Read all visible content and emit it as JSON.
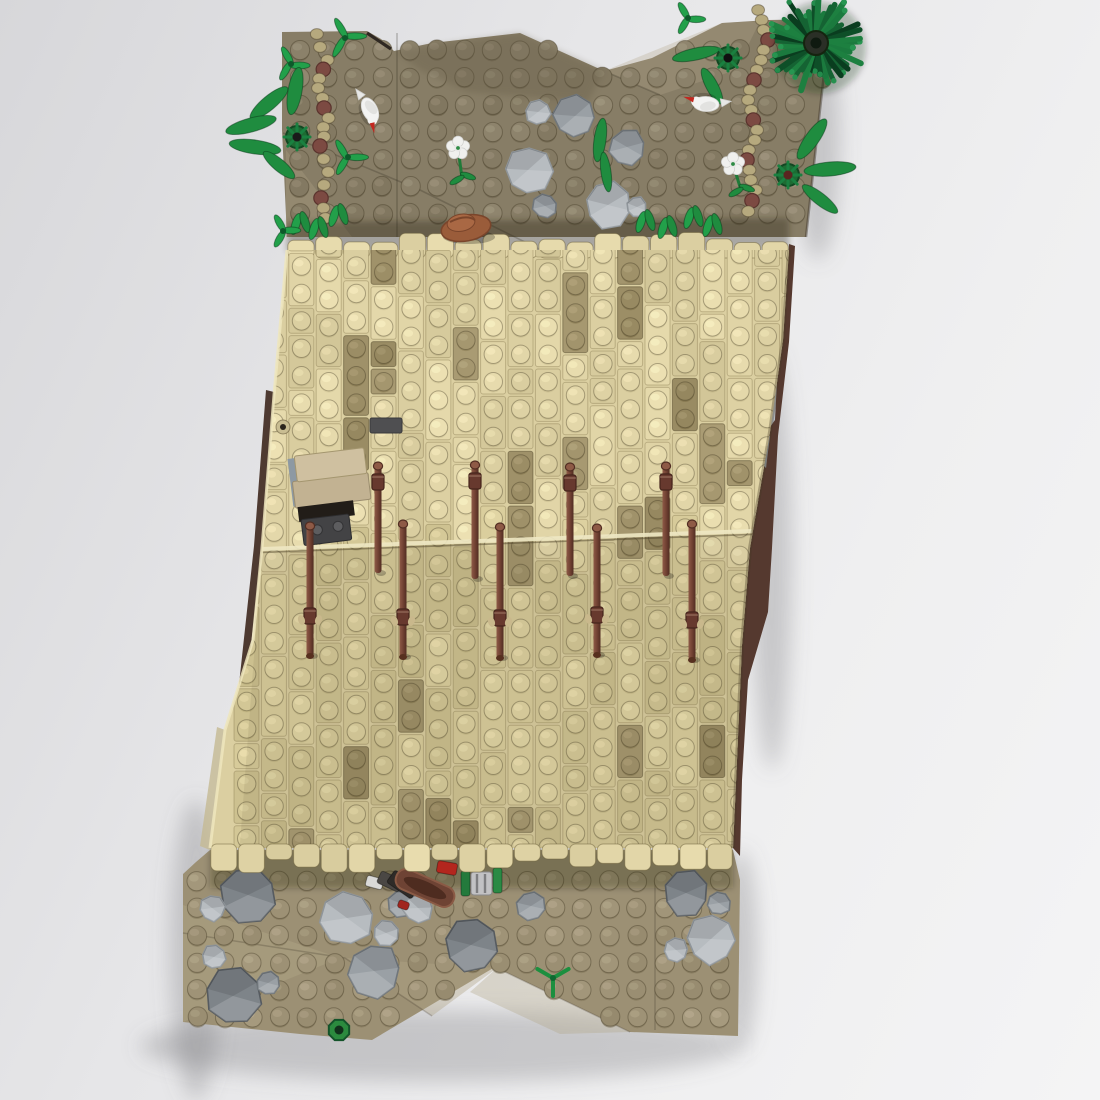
{
  "render": {
    "seed": 11,
    "canvas": {
      "w": 1100,
      "h": 1100
    }
  },
  "palette": {
    "bg_from": "#d7d7da",
    "bg_to": "#f4f4f5",
    "upper_ground": "#877d66",
    "upper_light": "#a59a7d",
    "upper_dark": "#6f6550",
    "lower_ground": "#9c9074",
    "lower_light": "#b2a687",
    "tan_upper": "#dbcfa1",
    "tan_lower": "#d2c695",
    "tan_recess": "#a2946c",
    "tan_deep": "#8a7e5c",
    "tan_light": "#e8dfb6",
    "seam_hi": "#efe8c4",
    "side_dark_left": "#4e3a31",
    "side_dark_right": "#55392f",
    "gray_sliver": "#b2b8bf",
    "gray_sliver2": "#98a2aa",
    "gray_sliver3": "#8d97a1",
    "bar_hi": "#8e5a46",
    "bar_mid": "#6f4032",
    "bar_dark": "#512d22",
    "bar_collar": "#67392e",
    "bar_nub": "#c9b88c",
    "rock_light": "#b7bcc0",
    "rock_mid": "#9aa0a5",
    "rock_dark": "#7e8489",
    "rock_light_s": "#8f959a",
    "rock_mid_s": "#70767b",
    "rock_dark_s": "#565b60",
    "green_bright": "#22a04a",
    "green_mid": "#1f8c3f",
    "green_dark": "#156333",
    "green_deep": "#0e4f28",
    "bird_body": "#f3f3f2",
    "bird_wing": "#e2e2e0",
    "beak_red": "#c3271f",
    "flower_petal": "#f0f0ee",
    "flower_center": "#2e8b44",
    "hat_main": "#9a5c3a",
    "hat_dark": "#7a452b",
    "hat_crown": "#a96844",
    "path_link": "#b6a97e",
    "path_bead": "#7c4a42",
    "shadow": "rgba(108,108,116,0.30)"
  },
  "upper_ground": {
    "outline": [
      [
        282,
        32
      ],
      [
        367,
        31
      ],
      [
        381,
        39
      ],
      [
        394,
        51
      ],
      [
        432,
        43
      ],
      [
        520,
        33
      ],
      [
        604,
        71
      ],
      [
        652,
        58
      ],
      [
        722,
        23
      ],
      [
        768,
        20
      ],
      [
        830,
        19
      ],
      [
        806,
        237
      ],
      [
        287,
        237
      ],
      [
        282,
        130
      ]
    ],
    "light_faces": [
      {
        "pts": [
          [
            604,
            71
          ],
          [
            722,
            23
          ],
          [
            760,
            21
          ],
          [
            736,
            70
          ],
          [
            660,
            95
          ]
        ],
        "fill": "#b3a78a",
        "op": 0.3
      },
      {
        "pts": [
          [
            286,
            150
          ],
          [
            352,
            237
          ],
          [
            286,
            237
          ]
        ],
        "fill": "#a59a7d",
        "op": 0.45
      }
    ],
    "dark_faces": [
      {
        "pts": [
          [
            394,
            51
          ],
          [
            520,
            33
          ],
          [
            604,
            71
          ],
          [
            588,
            102
          ],
          [
            468,
            92
          ],
          [
            420,
            70
          ]
        ],
        "fill": "#5e5440",
        "op": 0.28
      },
      {
        "pts": [
          [
            287,
            222
          ],
          [
            789,
            218
          ],
          [
            789,
            250
          ],
          [
            287,
            252
          ]
        ],
        "fill": "#241d10",
        "op": 0.32
      }
    ],
    "crease_lines": [
      [
        [
          420,
          190
        ],
        [
          545,
          252
        ]
      ],
      [
        [
          283,
          133
        ],
        [
          420,
          190
        ]
      ],
      [
        [
          604,
          71
        ],
        [
          660,
          95
        ]
      ],
      [
        [
          397,
          33
        ],
        [
          397,
          237
        ]
      ]
    ],
    "notch": [
      [
        367,
        33
      ],
      [
        391,
        49
      ]
    ],
    "stud_grid": {
      "x0": 300,
      "y0": 50,
      "dx": 27.5,
      "dy": 27.3,
      "cols": 20,
      "rows": 7,
      "r": 9.6
    }
  },
  "waterfall": {
    "body": [
      [
        287,
        250
      ],
      [
        789,
        250
      ],
      [
        783,
        340
      ],
      [
        770,
        432
      ],
      [
        750,
        548
      ],
      [
        742,
        645
      ],
      [
        737,
        760
      ],
      [
        733,
        848
      ],
      [
        210,
        848
      ],
      [
        225,
        730
      ],
      [
        253,
        640
      ],
      [
        262,
        548
      ],
      [
        274,
        395
      ]
    ],
    "top_teeth": {
      "x1": 287,
      "x2": 789,
      "base": 254,
      "hmin": 10,
      "hmax": 22,
      "w": 27.9
    },
    "bottom_teeth": {
      "x1": 210,
      "x2": 733,
      "base": 846,
      "hmin": 10,
      "hmax": 26,
      "w": 27.6
    },
    "left_edge": [
      [
        210,
        848
      ],
      [
        225,
        730
      ],
      [
        253,
        640
      ],
      [
        262,
        548
      ],
      [
        274,
        395
      ],
      [
        287,
        250
      ]
    ],
    "right_edge": [
      [
        789,
        250
      ],
      [
        783,
        340
      ],
      [
        770,
        432
      ],
      [
        750,
        548
      ],
      [
        742,
        645
      ],
      [
        737,
        760
      ],
      [
        733,
        848
      ]
    ],
    "seam": {
      "from": [
        262,
        549
      ],
      "to": [
        752,
        531
      ]
    },
    "columns": {
      "x0": 233,
      "dx": 27.4,
      "count": 21,
      "ytop": 231,
      "ybot": 860
    },
    "technic_hole": [
      283,
      427
    ],
    "dark_tile": {
      "x": 370,
      "y": 418,
      "w": 32,
      "h": 15
    }
  },
  "lower_ground": {
    "outline": [
      [
        196,
        862
      ],
      [
        210,
        850
      ],
      [
        733,
        850
      ],
      [
        740,
        880
      ],
      [
        738,
        1036
      ],
      [
        630,
        1032
      ],
      [
        495,
        967
      ],
      [
        372,
        1040
      ],
      [
        300,
        1034
      ],
      [
        183,
        1022
      ],
      [
        183,
        874
      ]
    ],
    "light_faces": [
      {
        "pts": [
          [
            183,
            905
          ],
          [
            340,
            958
          ],
          [
            183,
            1022
          ]
        ],
        "fill": "#b2a687",
        "op": 0.45
      },
      {
        "pts": [
          [
            345,
            958
          ],
          [
            497,
            968
          ],
          [
            432,
            1016
          ]
        ],
        "fill": "#b2a687",
        "op": 0.4
      },
      {
        "pts": [
          [
            497,
            968
          ],
          [
            630,
            1032
          ],
          [
            560,
            1034
          ],
          [
            470,
            992
          ]
        ],
        "fill": "#b2a687",
        "op": 0.35
      }
    ],
    "crease_lines": [
      [
        [
          183,
          933
        ],
        [
          345,
          958
        ]
      ],
      [
        [
          345,
          958
        ],
        [
          432,
          1016
        ]
      ],
      [
        [
          497,
          968
        ],
        [
          630,
          1032
        ]
      ],
      [
        [
          450,
          880
        ],
        [
          450,
          962
        ]
      ],
      [
        [
          655,
          880
        ],
        [
          655,
          1030
        ]
      ]
    ],
    "teeth_shadow": [
      [
        210,
        850
      ],
      [
        733,
        850
      ],
      [
        733,
        888
      ],
      [
        210,
        888
      ]
    ],
    "stud_grid": {
      "x0": 197,
      "y0": 881,
      "dx": 27.5,
      "dy": 27.2,
      "cols": 20,
      "rows": 7,
      "r": 9.6
    }
  },
  "side": {
    "left_strip": [
      [
        274,
        392
      ],
      [
        262,
        548
      ],
      [
        238,
        760
      ],
      [
        231,
        758
      ],
      [
        254,
        546
      ],
      [
        266,
        390
      ]
    ],
    "left_face": [
      [
        210,
        850
      ],
      [
        225,
        730
      ],
      [
        217,
        727
      ],
      [
        200,
        846
      ]
    ],
    "right_strip": [
      [
        789,
        244
      ],
      [
        795,
        246
      ],
      [
        789,
        342
      ],
      [
        778,
        436
      ],
      [
        772,
        548
      ],
      [
        768,
        612
      ],
      [
        748,
        680
      ],
      [
        742,
        780
      ],
      [
        740,
        856
      ],
      [
        733,
        848
      ],
      [
        737,
        760
      ],
      [
        742,
        645
      ],
      [
        750,
        548
      ],
      [
        770,
        432
      ],
      [
        783,
        340
      ]
    ],
    "right_gray": [
      [
        779,
        344
      ],
      [
        775,
        420
      ],
      [
        768,
        430
      ],
      [
        772,
        346
      ]
    ],
    "right_gray2": [
      [
        770,
        436
      ],
      [
        766,
        468
      ],
      [
        760,
        462
      ],
      [
        763,
        438
      ]
    ],
    "left_gray": [
      [
        244,
        668
      ],
      [
        256,
        670
      ],
      [
        251,
        696
      ],
      [
        239,
        694
      ]
    ],
    "top_edge_line": [
      [
        830,
        19
      ],
      [
        806,
        237
      ]
    ]
  },
  "shadows": [
    {
      "cx": 440,
      "cy": 1046,
      "rx": 300,
      "ry": 36
    },
    {
      "cx": 196,
      "cy": 950,
      "rx": 26,
      "ry": 150
    },
    {
      "cx": 818,
      "cy": 140,
      "rx": 22,
      "ry": 120
    },
    {
      "cx": 772,
      "cy": 560,
      "rx": 20,
      "ry": 210
    },
    {
      "cx": 740,
      "cy": 950,
      "rx": 18,
      "ry": 100
    }
  ],
  "bars": {
    "upper": {
      "xs": [
        378,
        475,
        570,
        666
      ],
      "y1": 458,
      "y2": 576,
      "collar": "top"
    },
    "lower": {
      "xs": [
        310,
        403,
        500,
        597,
        692
      ],
      "y1": 521,
      "y2": 658,
      "collar": "bottom"
    }
  },
  "table": {
    "slab1": [
      298,
      452,
      70,
      26
    ],
    "slab2": [
      293,
      477,
      76,
      27
    ],
    "gray_sliver": [
      291,
      454,
      11,
      48
    ],
    "dark_hole": [
      295,
      503,
      56,
      15
    ],
    "dark_tile": [
      297,
      516,
      48,
      26
    ],
    "tile_studs": [
      [
        312,
        528
      ],
      [
        333,
        527
      ]
    ]
  },
  "rocks_top": [
    [
      538,
      112,
      13,
      "light"
    ],
    [
      575,
      116,
      21,
      "mid"
    ],
    [
      627,
      147,
      18,
      "mid"
    ],
    [
      528,
      170,
      24,
      "light"
    ],
    [
      545,
      206,
      12,
      "mid"
    ],
    [
      608,
      205,
      23,
      "light"
    ],
    [
      637,
      207,
      10,
      "light"
    ]
  ],
  "rocks_bottom": [
    [
      248,
      895,
      28,
      "dark"
    ],
    [
      212,
      908,
      13,
      "light"
    ],
    [
      347,
      918,
      26,
      "light"
    ],
    [
      386,
      933,
      13,
      "light"
    ],
    [
      374,
      971,
      27,
      "mid"
    ],
    [
      471,
      945,
      26,
      "dark"
    ],
    [
      214,
      957,
      12,
      "light"
    ],
    [
      233,
      996,
      28,
      "dark"
    ],
    [
      268,
      983,
      12,
      "mid"
    ],
    [
      531,
      906,
      14,
      "mid"
    ],
    [
      402,
      904,
      14,
      "mid"
    ],
    [
      686,
      893,
      23,
      "dark"
    ],
    [
      719,
      903,
      12,
      "mid"
    ],
    [
      711,
      939,
      25,
      "light"
    ],
    [
      676,
      950,
      12,
      "light"
    ]
  ],
  "paths": {
    "left": [
      [
        318,
        34
      ],
      [
        326,
        60
      ],
      [
        318,
        88
      ],
      [
        327,
        118
      ],
      [
        320,
        146
      ],
      [
        328,
        172
      ],
      [
        321,
        198
      ],
      [
        330,
        228
      ]
    ],
    "right": [
      [
        760,
        10
      ],
      [
        768,
        40
      ],
      [
        757,
        70
      ],
      [
        748,
        100
      ],
      [
        756,
        130
      ],
      [
        747,
        160
      ],
      [
        755,
        190
      ],
      [
        746,
        222
      ]
    ],
    "bead_every": 4
  },
  "sprigs": [
    [
      345,
      38,
      16
    ],
    [
      291,
      64,
      14
    ],
    [
      348,
      157,
      15
    ],
    [
      283,
      231,
      13
    ],
    [
      688,
      18,
      13
    ]
  ],
  "wheel_plants": [
    {
      "c": [
        297,
        137
      ],
      "center": "#1a1a1a",
      "leaves": [
        [
          -28,
          -34,
          -40,
          24,
          7
        ],
        [
          -46,
          -12,
          -15,
          26,
          7
        ],
        [
          -42,
          10,
          8,
          26,
          7
        ],
        [
          -18,
          28,
          40,
          20,
          6
        ],
        [
          -2,
          -46,
          -80,
          24,
          7
        ]
      ]
    },
    {
      "c": [
        728,
        58
      ],
      "center": "#101010",
      "leaves": [
        [
          -32,
          -4,
          -12,
          24,
          6
        ],
        [
          -16,
          28,
          62,
          20,
          6
        ]
      ]
    },
    {
      "c": [
        788,
        175
      ],
      "center": "#5a2420",
      "leaves": [
        [
          24,
          -36,
          -55,
          24,
          7
        ],
        [
          42,
          -6,
          -5,
          26,
          7
        ],
        [
          32,
          24,
          38,
          22,
          6
        ]
      ]
    }
  ],
  "single_leaves": [
    [
      600,
      140,
      -82,
      22,
      6
    ],
    [
      606,
      172,
      -98,
      20,
      5
    ]
  ],
  "leaf_tufts": [
    [
      300,
      224
    ],
    [
      318,
      229
    ],
    [
      338,
      216
    ],
    [
      645,
      222
    ],
    [
      667,
      228
    ],
    [
      693,
      218
    ],
    [
      712,
      226
    ]
  ],
  "birds": [
    {
      "c": [
        370,
        110
      ],
      "rot": 65
    },
    {
      "c": [
        706,
        104
      ],
      "rot": 183
    }
  ],
  "flowers": [
    {
      "c": [
        458,
        148
      ],
      "stem_end": [
        462,
        178
      ]
    },
    {
      "c": [
        733,
        164
      ],
      "stem_end": [
        741,
        190
      ]
    }
  ],
  "tree": {
    "c": [
      816,
      43
    ],
    "core_r": 30,
    "hub_r": 12,
    "spikes": 46,
    "len_min": 20,
    "len_max": 42
  },
  "hat": {
    "c": [
      466,
      228
    ]
  },
  "vignette": {
    "rock": [
      418,
      908,
      15
    ],
    "pieces": [
      {
        "t": "rect",
        "x": 366,
        "y": 877,
        "w": 17,
        "h": 11,
        "rot": 15,
        "f": "#d9d9d7"
      },
      {
        "t": "rect",
        "x": 378,
        "y": 875,
        "w": 24,
        "h": 13,
        "rot": 25,
        "f": "#4a4744"
      },
      {
        "t": "rect",
        "x": 388,
        "y": 877,
        "w": 30,
        "h": 15,
        "rot": 35,
        "f": "#2e2b28"
      },
      {
        "t": "canoe",
        "x": 425,
        "y": 888,
        "w": 62,
        "h": 21,
        "rot": 24,
        "f": "#6e4334",
        "rim": "#8a5a45",
        "inner": "#4e2c20"
      },
      {
        "t": "rect",
        "x": 437,
        "y": 862,
        "w": 20,
        "h": 12,
        "rot": 10,
        "f": "#b3261e"
      },
      {
        "t": "rect",
        "x": 398,
        "y": 901,
        "w": 11,
        "h": 8,
        "rot": 20,
        "f": "#a1251e"
      },
      {
        "t": "rect",
        "x": 461,
        "y": 871,
        "w": 9,
        "h": 25,
        "rot": 0,
        "f": "#237a3c"
      },
      {
        "t": "barrel",
        "x": 471,
        "y": 872,
        "w": 21,
        "h": 23,
        "f": "#c2c2c4",
        "stripe": "#7e7e80"
      },
      {
        "t": "rect",
        "x": 493,
        "y": 868,
        "w": 9,
        "h": 25,
        "rot": 0,
        "f": "#2a8a44"
      }
    ]
  },
  "green_items": {
    "y_plant": [
      553,
      978
    ],
    "ring": [
      339,
      1030
    ]
  }
}
